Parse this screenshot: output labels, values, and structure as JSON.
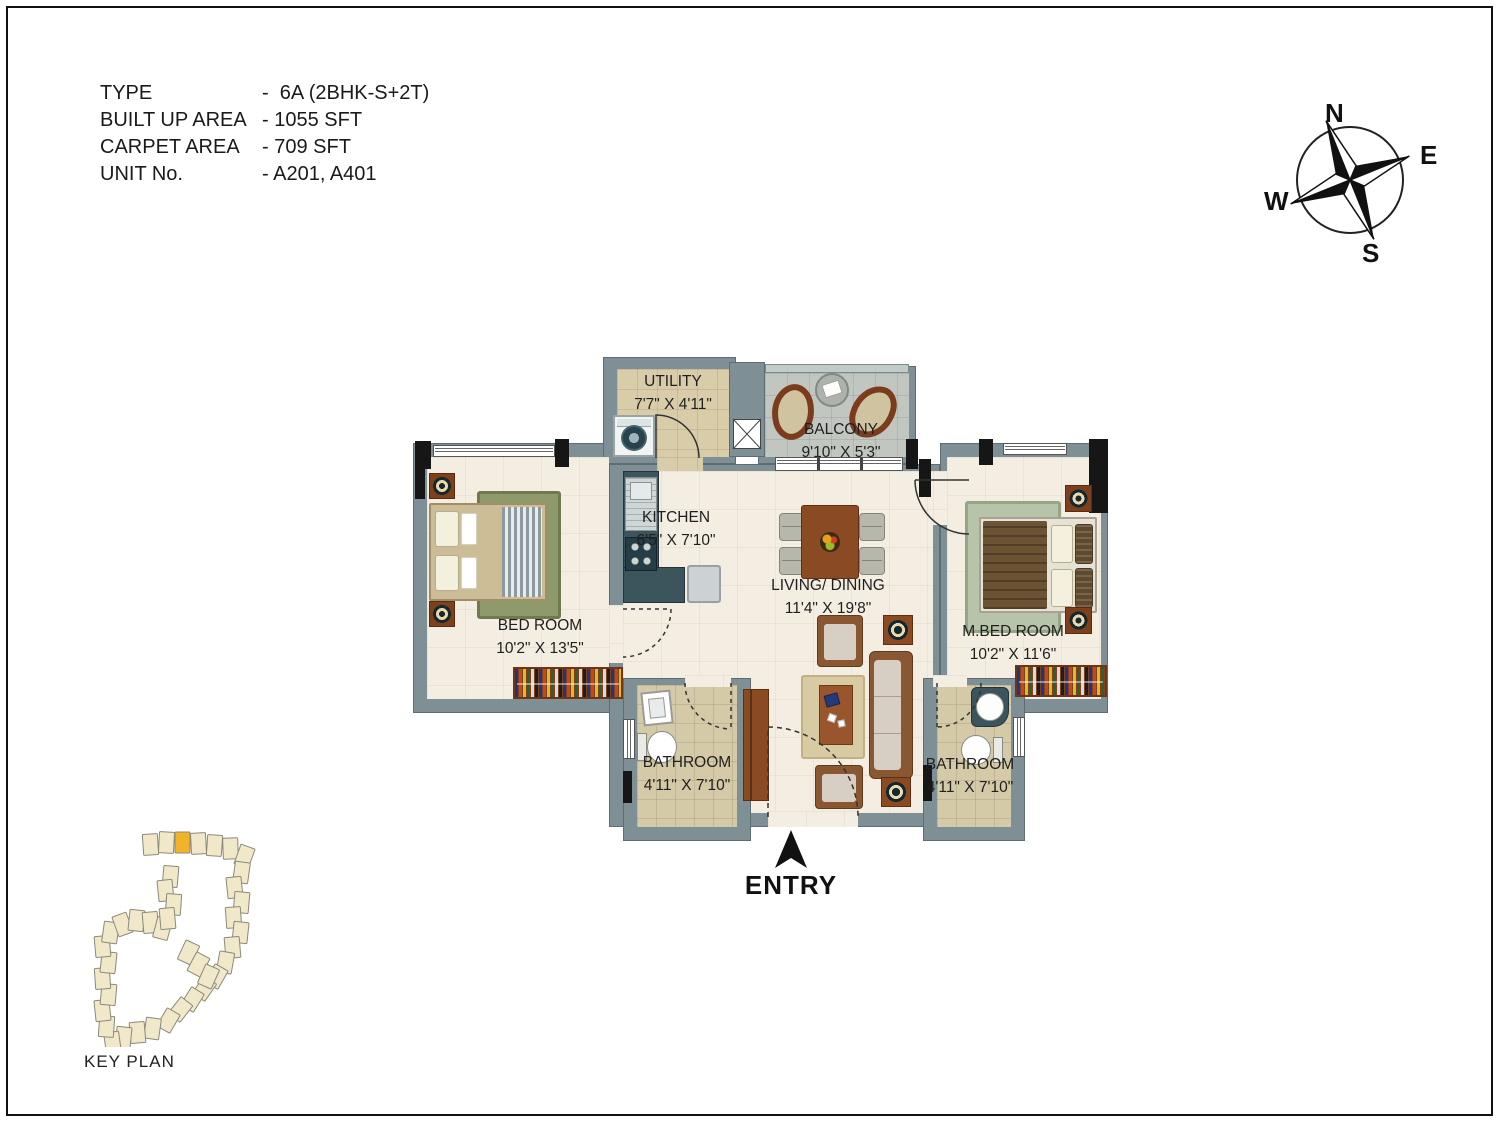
{
  "info": {
    "rows": [
      {
        "label": "TYPE",
        "value": "-  6A (2BHK-S+2T)"
      },
      {
        "label": "BUILT UP AREA",
        "value": "- 1055 SFT"
      },
      {
        "label": "CARPET AREA",
        "value": "- 709 SFT"
      },
      {
        "label": "UNIT No.",
        "value": "- A201, A401"
      }
    ]
  },
  "compass": {
    "labels": {
      "n": "N",
      "e": "E",
      "s": "S",
      "w": "W"
    }
  },
  "plan": {
    "rooms": {
      "utility": {
        "name": "UTILITY",
        "dim": "7'7\" X 4'11\""
      },
      "balcony": {
        "name": "BALCONY",
        "dim": "9'10\" X 5'3\""
      },
      "kitchen": {
        "name": "KITCHEN",
        "dim": "6'5\" X 7'10\""
      },
      "living_dining": {
        "name": "LIVING/ DINING",
        "dim": "11'4\" X 19'8\""
      },
      "bedroom": {
        "name": "BED ROOM",
        "dim": "10'2\" X 13'5\""
      },
      "master_bedroom": {
        "name": "M.BED ROOM",
        "dim": "10'2\" X 11'6\""
      },
      "bathroom_1": {
        "name": "BATHROOM",
        "dim": "4'11\" X 7'10\""
      },
      "bathroom_2": {
        "name": "BATHROOM",
        "dim": "4'11\" X 7'10\""
      }
    },
    "entry_label": "ENTRY"
  },
  "key_plan": {
    "label": "KEY PLAN"
  },
  "colors": {
    "wall": "#7e9095",
    "wall_edge": "#5d6d72",
    "floor_cream": "#f3eee1",
    "floor_tan": "#d9cca9",
    "floor_gray": "#c2c6c0",
    "floor_bath": "#d4caa8",
    "accent_black": "#161616",
    "furn_brown": "#8a4a26",
    "counter_dark": "#3c545c",
    "rug_olive": "#8f9a6c",
    "rug_sage": "#b7c4a9",
    "bed_tan": "#cdbd96",
    "blanket_brown": "#6b5334",
    "highlight_orange": "#f2b32a",
    "keyplan_fill": "#f0e8c8"
  }
}
